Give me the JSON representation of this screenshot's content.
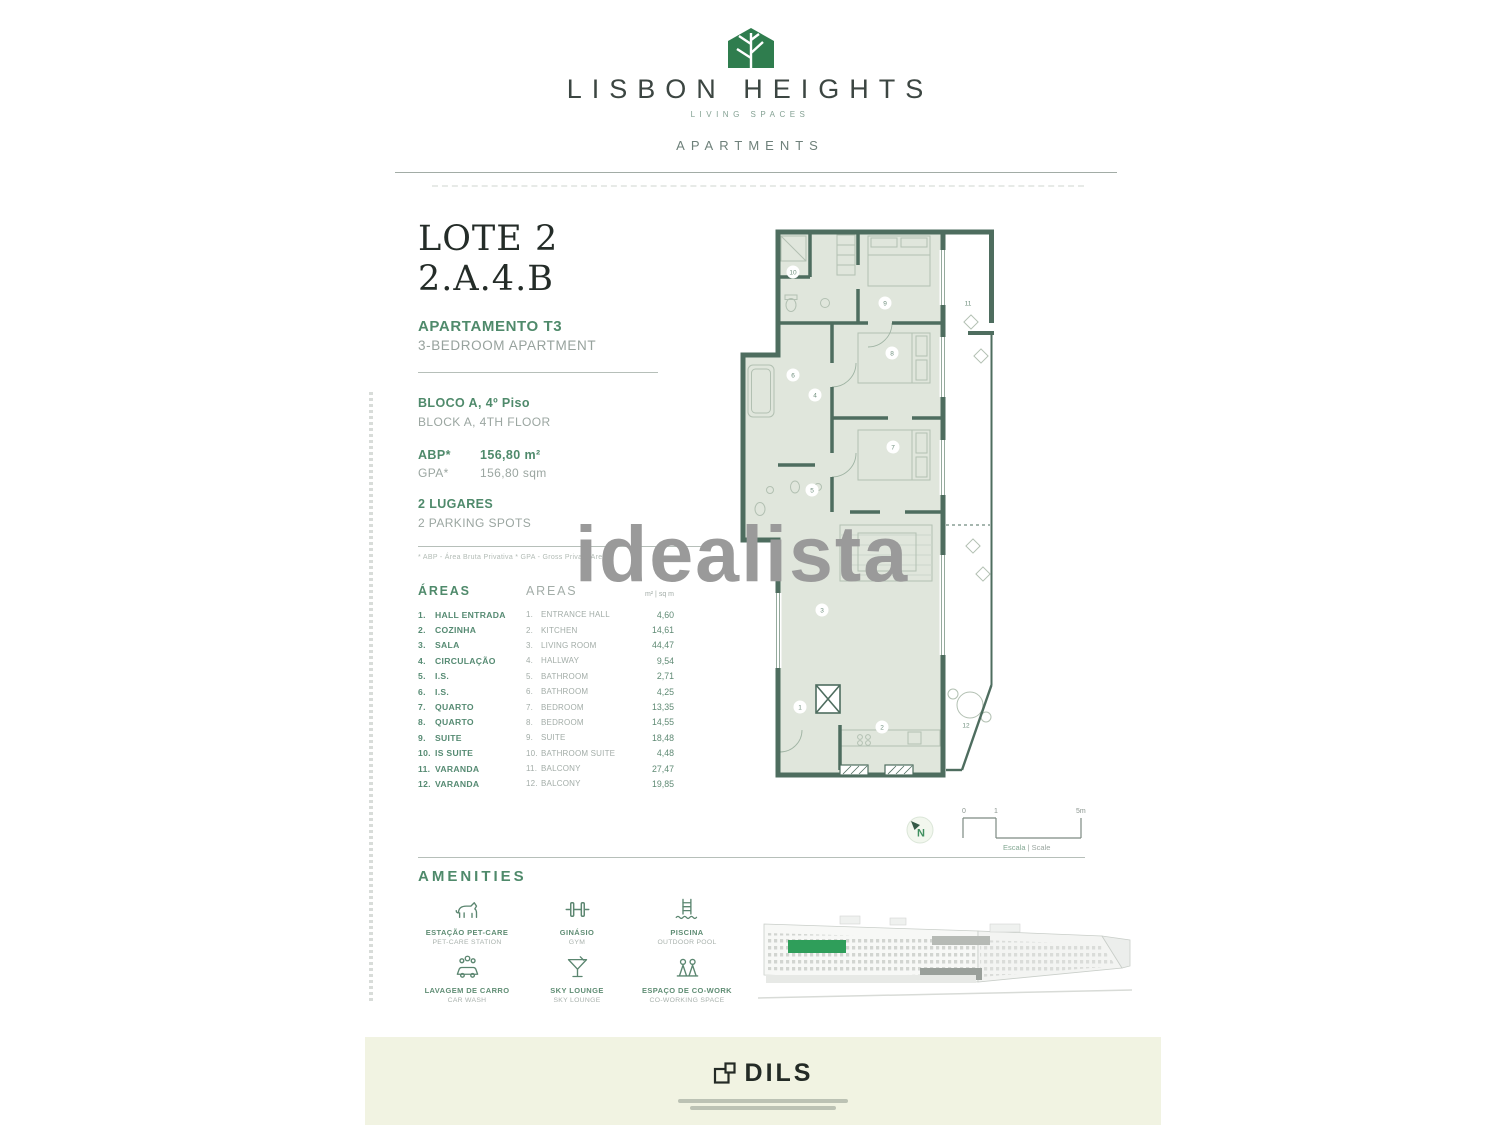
{
  "header": {
    "brand": "LISBON HEIGHTS",
    "tagline": "LIVING SPACES",
    "subtitle": "APARTMENTS"
  },
  "title": {
    "lot": "LOTE 2",
    "unit": "2.A.4.B",
    "type_pt": "APARTAMENTO T3",
    "type_en": "3-BEDROOM APARTMENT"
  },
  "details": {
    "block_pt": "BLOCO A, 4º Piso",
    "block_en": "BLOCK A, 4TH FLOOR",
    "abp_label": "ABP*",
    "abp_value": "156,80 m²",
    "gpa_label": "GPA*",
    "gpa_value": "156,80 sqm",
    "parking_pt": "2 LUGARES",
    "parking_en": "2 PARKING SPOTS",
    "footnote": "* ABP - Área Bruta Privativa    * GPA - Gross Private Area"
  },
  "areas": {
    "header_pt": "ÁREAS",
    "header_en": "AREAS",
    "header_unit": "m² | sq m",
    "rows": [
      {
        "n": "1.",
        "pt": "HALL ENTRADA",
        "en": "ENTRANCE HALL",
        "v": "4,60"
      },
      {
        "n": "2.",
        "pt": "COZINHA",
        "en": "KITCHEN",
        "v": "14,61"
      },
      {
        "n": "3.",
        "pt": "SALA",
        "en": "LIVING ROOM",
        "v": "44,47"
      },
      {
        "n": "4.",
        "pt": "CIRCULAÇÃO",
        "en": "HALLWAY",
        "v": "9,54"
      },
      {
        "n": "5.",
        "pt": "I.S.",
        "en": "BATHROOM",
        "v": "2,71"
      },
      {
        "n": "6.",
        "pt": "I.S.",
        "en": "BATHROOM",
        "v": "4,25"
      },
      {
        "n": "7.",
        "pt": "QUARTO",
        "en": "BEDROOM",
        "v": "13,35"
      },
      {
        "n": "8.",
        "pt": "QUARTO",
        "en": "BEDROOM",
        "v": "14,55"
      },
      {
        "n": "9.",
        "pt": "SUITE",
        "en": "SUITE",
        "v": "18,48"
      },
      {
        "n": "10.",
        "pt": "IS SUITE",
        "en": "BATHROOM SUITE",
        "v": "4,48"
      },
      {
        "n": "11.",
        "pt": "VARANDA",
        "en": "BALCONY",
        "v": "27,47"
      },
      {
        "n": "12.",
        "pt": "VARANDA",
        "en": "BALCONY",
        "v": "19,85"
      }
    ]
  },
  "plan": {
    "north_label": "N",
    "scale_ticks": [
      "0",
      "1",
      "5m"
    ],
    "scale_label_pt": "Escala",
    "scale_label_en": " | Scale",
    "room_numbers": [
      "1",
      "2",
      "3",
      "4",
      "5",
      "6",
      "7",
      "8",
      "9",
      "10",
      "11",
      "12"
    ]
  },
  "amenities": {
    "heading": "AMENITIES",
    "items": [
      {
        "icon": "pet-care-icon",
        "pt": "ESTAÇÃO PET-CARE",
        "en": "PET-CARE STATION"
      },
      {
        "icon": "gym-icon",
        "pt": "GINÁSIO",
        "en": "GYM"
      },
      {
        "icon": "pool-icon",
        "pt": "PISCINA",
        "en": "OUTDOOR POOL"
      },
      {
        "icon": "car-wash-icon",
        "pt": "LAVAGEM DE CARRO",
        "en": "CAR WASH"
      },
      {
        "icon": "sky-lounge-icon",
        "pt": "SKY LOUNGE",
        "en": "SKY LOUNGE"
      },
      {
        "icon": "co-work-icon",
        "pt": "ESPAÇO DE CO-WORK",
        "en": "CO-WORKING SPACE"
      }
    ]
  },
  "watermark": "idealista",
  "footer": {
    "brand": "DILS"
  },
  "colors": {
    "brand_green": "#2f7d4e",
    "accent_green": "#4f8a6b",
    "wall_green": "#4e6d5f",
    "room_fill": "#e0e6dc",
    "text_gray": "#9aa5a1",
    "footer_cream": "#f1f3e2",
    "watermark_gray": "#9a9a9a"
  }
}
